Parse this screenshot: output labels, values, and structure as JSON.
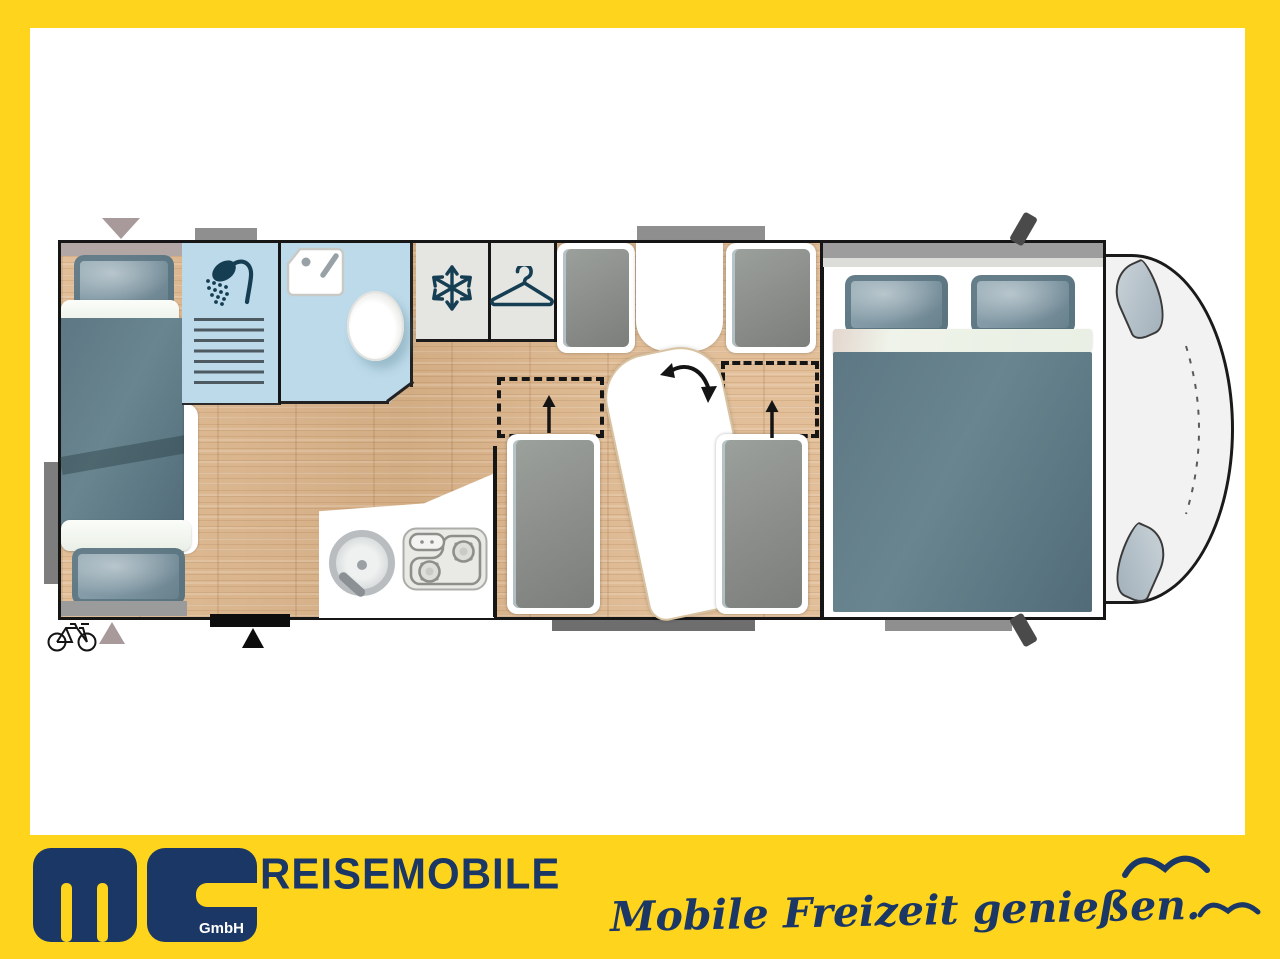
{
  "branding": {
    "logo_text": "ms",
    "logo_suffix": "GmbH",
    "wordmark": "REISEMOBILE",
    "slogan": "Mobile Freizeit genießen."
  },
  "colors": {
    "banner_yellow": "#FFD41C",
    "brand_navy": "#1B3765",
    "icon_teal": "#163E53",
    "bathroom_blue": "#BDDAEA",
    "wood_light": "#E2BF99",
    "wood_dark": "#D2AC83",
    "blanket_teal": "#64808B",
    "pillow_blue": "#7E96A2",
    "cushion_gray": "#8E908D",
    "panel_gray": "#E5E5E2",
    "wall_dark": "#161616",
    "cab_gray": "#F2F2F2",
    "marker_taupe": "#A89A9A",
    "marker_gray": "#8F8F8F",
    "white": "#FFFFFF"
  },
  "floorplan": {
    "icons": {
      "shower": "shower-icon",
      "washbasin": "washbasin-icon",
      "toilet": "toilet-shape",
      "fridge": "snowflake-icon",
      "wardrobe": "hanger-icon",
      "stove": "stove-icon",
      "kitchen_sink": "sink-icon",
      "table_swivel": "rotation-arrow-icon",
      "bed_convert": "up-arrow-icon",
      "bike_storage": "bicycle-icon",
      "entry_door": "door-triangle-icon"
    }
  }
}
